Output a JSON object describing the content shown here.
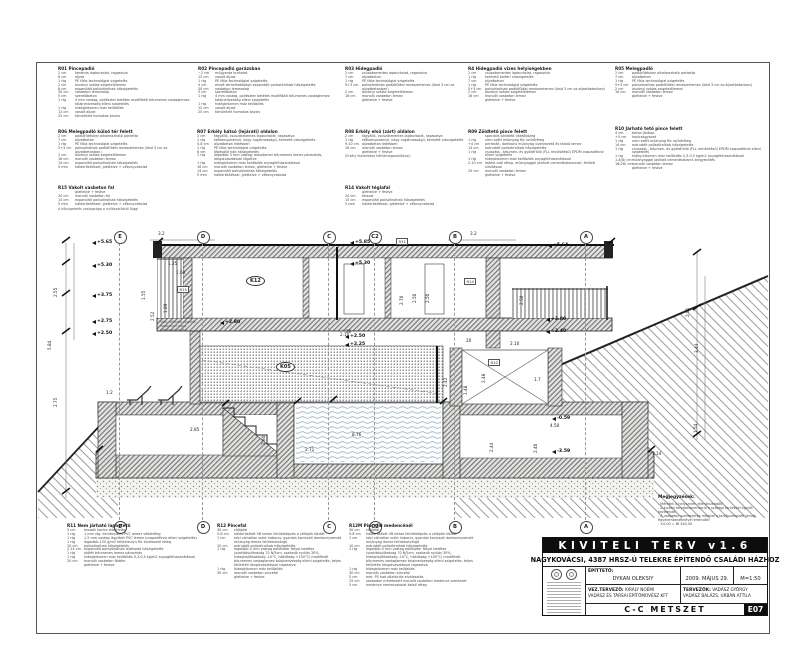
{
  "title_block": {
    "banner": "KIVITELI TERV v1.6",
    "project": "NAGYKOVÁCSI, 4387 HRSZ-Ú TELEKRE ÉPÍTENDŐ CSALÁDI HÁZHOZ",
    "client_label": "ÉPÍTTETŐ:",
    "client": "DYKAN OLEKSIY",
    "date": "2009. MÁJUS 29.",
    "scale": "M=1:50",
    "lead_label": "VEZ.TERVEZŐ:",
    "lead": "KIRÁLY NOÉMI",
    "firm": "VADÁSZ ÉS TÁRSAI ÉPÍTŐMŰVÉSZ KFT",
    "designers_label": "TERVEZŐK:",
    "designer1": "VADÁSZ GYÖRGY",
    "designer2": "VADÁSZ BALÁZS, URBÁN ATTILA",
    "drawing_title": "C-C METSZET",
    "sheet_code": "E07"
  },
  "notes": {
    "heading": "Megjegyzések:",
    "lines": [
      "- Méretek a helyszínen ellenőrizendők!",
      "- A kiviteli tervdokumentáció a szakági tervekkel együtt kezelendő!",
      "- A vasbeton szerkezetek méretei a tartószerkezeti tervek figyelembevételével értendők!",
      "- ±0,00 = Bf 340,00"
    ]
  },
  "colors": {
    "line": "#333333",
    "hatch": "#8a8a8a",
    "water": "#8fa3ad",
    "titleblock_bg": "#0d0d0d"
  },
  "spec_blocks": [
    {
      "id": "R01",
      "title": "Pincepadló",
      "x": 58,
      "y": 67,
      "w": 135,
      "rows": [
        [
          "2 cm",
          "kerámia lapburkolat, ragasztva"
        ],
        [
          "6 cm",
          "aljzat"
        ],
        [
          "1 rtg",
          "PE fólia technológiai szigetelés"
        ],
        [
          "2 cm",
          "ásványi szálas szigetelőlemez"
        ],
        [
          "6 cm",
          "expandált polisztirolhab hőszigetelés"
        ],
        [
          "30 cm",
          "vasbeton lemezalap"
        ],
        [
          "5 cm",
          "szerelőbeton"
        ],
        [
          "1 rtg",
          "4 mm vastag, poliészter betétes modifikált bitumenes vastaglemez talajnedvesség elleni szigetelés"
        ],
        [
          "1 rtg",
          "hidegbitumen máz kellősítés"
        ],
        [
          "12 cm",
          "vasalt aljzat"
        ],
        [
          "25 cm",
          "tömörített homokos kavics"
        ]
      ]
    },
    {
      "id": "R02",
      "title": "Pincepadló garázsban",
      "x": 198,
      "y": 67,
      "w": 142,
      "rows": [
        [
          "~2 cm",
          "műgyanta burkolat"
        ],
        [
          "12 cm",
          "vasalt aljzat"
        ],
        [
          "1 rtg",
          "PE fólia technológiai szigetelés"
        ],
        [
          "4 cm",
          "emelt terhelhetőségű expandált polisztirolhab hőszigetelés"
        ],
        [
          "30 cm",
          "vasbeton lemezalap"
        ],
        [
          "5 cm",
          "szerelőbeton"
        ],
        [
          "1 rtg",
          "4 mm vastag, poliészter betétes modifikált bitumenes vastaglemez talajnedvesség elleni szigetelés"
        ],
        [
          "1 rtg",
          "hidegbitumen máz kellősítés"
        ],
        [
          "12 cm",
          "vasalt aljzat"
        ],
        [
          "25 cm",
          "tömörített homokos kavics"
        ]
      ]
    },
    {
      "id": "R03",
      "title": "Hidegpadló",
      "x": 345,
      "y": 67,
      "w": 120,
      "rows": [
        [
          "2 cm",
          "csúszásmentes lapburkolat, ragasztva"
        ],
        [
          "7 cm",
          "aljzatbeton"
        ],
        [
          "1 rtg",
          "PE fólia technológiai szigetelés"
        ],
        [
          "5+3 cm",
          "polisztirolhab padlófűtési rendszerlemez (lásd 3 cm az aljzatbetonban)"
        ],
        [
          "2 cm",
          "ásványi szálas szigetelőlemez"
        ],
        [
          "16 cm",
          "monolit vasbeton lemez"
        ],
        [
          "",
          "glettelve + festve"
        ]
      ]
    },
    {
      "id": "R4",
      "title": "Hidegpadló vizes helyiségekben",
      "x": 468,
      "y": 67,
      "w": 142,
      "rows": [
        [
          "2 cm",
          "csúszásmentes lapburkolat, ragasztva"
        ],
        [
          "1 rtg",
          "kenhető beltéri vízszigetelés"
        ],
        [
          "7 cm",
          "aljzatbeton"
        ],
        [
          "1 rtg",
          "PE fólia technológiai szigetelés"
        ],
        [
          "5+3 cm",
          "polisztirolhab padlófűtési rendszerlemez (lásd 3 cm az aljzatbetonban)"
        ],
        [
          "2 cm",
          "ásványi szálas szigetelőlemez"
        ],
        [
          "16 cm",
          "monolit vasbeton lemez"
        ],
        [
          "",
          "glettelve + festve"
        ]
      ]
    },
    {
      "id": "R05",
      "title": "Melegpadló",
      "x": 615,
      "y": 67,
      "w": 148,
      "rows": [
        [
          "2 cm",
          "padlófűtéshez alkalmazható parketta"
        ],
        [
          "7 cm",
          "aljzatbeton"
        ],
        [
          "1 rtg",
          "PE fólia technológiai szigetelés"
        ],
        [
          "5+3 cm",
          "polisztirolhab padlófűtési rendszerlemez (lásd 3 cm az aljzatbetonban)"
        ],
        [
          "2 cm",
          "ásványi szálas szigetelőlemez"
        ],
        [
          "16 cm",
          "monolit vasbeton lemez"
        ],
        [
          "",
          "glettelve + festve"
        ]
      ]
    },
    {
      "id": "R06",
      "title": "Melegpadló külső tér felett",
      "x": 58,
      "y": 130,
      "w": 135,
      "rows": [
        [
          "2 cm",
          "padlófűtéshez alkalmazható parketta"
        ],
        [
          "7 cm",
          "aljzatbeton"
        ],
        [
          "1 rtg",
          "PE fólia technológiai szigetelés"
        ],
        [
          "5+3 cm",
          "polisztirolhab padlófűtési rendszerlemez (lásd 3 cm az aljzatbetonban)"
        ],
        [
          "2 cm",
          "ásványi szálas szigetelőlemez"
        ],
        [
          "16 cm",
          "monolit vasbeton lemez"
        ],
        [
          "14 cm",
          "expandált polisztirolhab hőszigetelés"
        ],
        [
          "5 mm",
          "hálóerősítéssel, glettelve + vékonyvakolat"
        ]
      ]
    },
    {
      "id": "R07",
      "title": "Erkély hátsó (lejárati) oldalon",
      "x": 197,
      "y": 130,
      "w": 143,
      "rows": [
        [
          "2 cm",
          "fagyálló, csúszásmentes lapburkolat, ragasztva"
        ],
        [
          "1 rtg",
          "kétkomponensű, nagy rugalmasságú, kenhető vízszigetelés"
        ],
        [
          "5-6 cm",
          "aljzatbeton lejtésben"
        ],
        [
          "1 rtg",
          "PE fólia technológiai szigetelés"
        ],
        [
          "6 cm",
          "lépésálló hab hőszigetelés"
        ],
        [
          "1 rtg",
          "legalább 3 mm vastag, elasztomer bitumenes lemez párazárás, lángolvasztással rögzítve"
        ],
        [
          "1 rtg",
          "hidegbitumen máz kellősítés anyagfelhasználással"
        ],
        [
          "16 cm",
          "monolit vasbeton lemez, glettelve + festve"
        ],
        [
          "14 cm",
          "expandált polisztirolhab hőszigetelés"
        ],
        [
          "5 mm",
          "hálóerősítéssel, glettelve + vékonyvakolat"
        ]
      ]
    },
    {
      "id": "R08",
      "title": "Erkély első (zárt) oldalon",
      "x": 345,
      "y": 130,
      "w": 150,
      "rows": [
        [
          "2 cm",
          "fagyálló, csúszásmentes lapburkolat, ragasztva"
        ],
        [
          "1 rtg",
          "kétkomponensű, nagy rugalmasságú, kenhető vízszigetelés"
        ],
        [
          "9-10 cm",
          "aljzatbeton lejtésben"
        ],
        [
          "16 cm",
          "monolit vasbeton lemez"
        ],
        [
          "",
          "glettelve + festve"
        ]
      ],
      "note": "(Erkély kialakítása hőhídmegszakítóval)"
    },
    {
      "id": "R09",
      "title": "Zöldtető pince felett",
      "x": 468,
      "y": 130,
      "w": 142,
      "rows": [
        [
          "",
          "speciális zöldtető ültetőközeg"
        ],
        [
          "1 rtg",
          "nem szőtt műanyag filc szűrőréteg"
        ],
        [
          "+4 cm",
          "perforált, domború műanyag vízelvezető és tároló lemez"
        ],
        [
          "14 cm",
          "extrudált polisztirolhab hőszigetelés"
        ],
        [
          "1 rtg",
          "csúszást-, bitumen- és gyökérálló (FLL minősítésű) EPDM csapadékvíz elleni szigetelés"
        ],
        [
          "1 rtg",
          "hidegbitumen máz kellősítés anyagfelhasználással"
        ],
        [
          "2-10 cm",
          "lejtést adó réteg, műanyaggal javított cementhabarccsal, felületi simítással"
        ],
        [
          "25 cm",
          "monolit vasbeton lemez"
        ],
        [
          "",
          "glettelve + festve"
        ]
      ]
    },
    {
      "id": "R10",
      "title": "Járható tető pince felett",
      "x": 615,
      "y": 127,
      "w": 150,
      "rows": [
        [
          "4 cm",
          "beton járólap"
        ],
        [
          "+5 cm",
          "kavicságyazat"
        ],
        [
          "1 rtg",
          "nem szőtt műanyag filc szűrőréteg"
        ],
        [
          "14 cm",
          "extrudált polisztirolhab hőszigetelés"
        ],
        [
          "1 rtg",
          "csúszást-, bitumen- és gyökérálló (FLL minősítésű) EPDM csapadékvíz elleni szigetelés"
        ],
        [
          "1 rtg",
          "hideg bitumen máz kellősítés 0,3-0,5 kg/m2 anyagfelhasználással"
        ],
        [
          "1-4(8) cm",
          "műanyaggal javított cementhabarcs kiegyenlítés"
        ],
        [
          "16(26) cm",
          "monolit vasbeton lemez"
        ],
        [
          "",
          "glettelve + festve"
        ]
      ]
    },
    {
      "id": "R15",
      "title": "Vakolt vasbeton fal",
      "x": 58,
      "y": 186,
      "w": 170,
      "rows": [
        [
          "",
          "glettelve + festve"
        ],
        [
          "20 cm",
          "monolit vasbeton fal"
        ],
        [
          "15 cm",
          "expandált polisztirolhab hőszigetelés"
        ],
        [
          "5 mm",
          "hálóerősítéssel, glettelve + vékonyvakolat"
        ]
      ],
      "note": "A hőszigetelés vastagsága a nyílászáróktól függ!"
    },
    {
      "id": "R14",
      "title": "Vakolt téglafal",
      "x": 345,
      "y": 186,
      "w": 150,
      "rows": [
        [
          "",
          "glettelve + festve"
        ],
        [
          "20 cm",
          "falazat"
        ],
        [
          "15 cm",
          "expandált polisztirolhab hőszigetelés"
        ],
        [
          "5 mm",
          "hálóerősítéssel, glettelve + vékonyvakolat"
        ]
      ]
    },
    {
      "id": "R11",
      "title": "Nem járható lapostető",
      "x": 67,
      "y": 524,
      "w": 195,
      "rows": [
        [
          "5 cm",
          "mosott kavics leterhelés"
        ],
        [
          "1 rtg",
          "1 mm vtg. keményített PVC lemez védőréteg"
        ],
        [
          "1 rtg",
          "1,5 mm vastag lágyított PVC lemez (csapadékvíz elleni szigetelés)"
        ],
        [
          "1 rtg",
          "legalább 120 g/m2 felületsúlyú filc elválasztó réteg"
        ],
        [
          "10 cm",
          "polisztirolhab hőszigetelés"
        ],
        [
          "2-14 cm",
          "expandált polisztirolhab lejtésadó hőszigetelés"
        ],
        [
          "1 rtg",
          "alátét bitumenes lemez párazárás"
        ],
        [
          "1 rtg",
          "hidegbitumen máz kellősítés 0,3-0,5 kg/m2 anyagfelhasználással"
        ],
        [
          "20 cm",
          "monolit vasbeton födém"
        ],
        [
          "",
          "glettelve + festve"
        ]
      ]
    },
    {
      "id": "R12",
      "title": "Pincefal",
      "x": 217,
      "y": 524,
      "w": 126,
      "rows": [
        [
          "30 cm",
          "cölöpfal"
        ],
        [
          "5-8 cm",
          "hálóerősített VB beton felületképzés a cölöpök között"
        ],
        [
          "1 cm",
          "kézi vízhatlan szórt habarcs, gyantás kavicsolt dombornyomott műanyag lemez felületszivárgó"
        ],
        [
          "10 cm",
          "extrudált polisztirolhab hőszigetelés"
        ],
        [
          "1 rtg",
          "legalább 4 mm vastag poliészter fátyol betétes (szakítószilárdság 70 N/5cm, szakadó nyúlás 30%, hideghajlíthatóság -10°C, hőállóság +100°C) modifikált bitumenes vastaglemez talajnedvesség elleni szigetelés, teljes felületén lángolvasztással ragasztva"
        ],
        [
          "1 rtg",
          "hidegbitumen máz kellősítés"
        ],
        [
          "30 cm",
          "monolit vasbeton pincefal"
        ],
        [
          "",
          "glettelve + festve"
        ]
      ]
    },
    {
      "id": "R12M",
      "title": "Pincefal medencénél",
      "x": 349,
      "y": 524,
      "w": 128,
      "rows": [
        [
          "30 cm",
          "cölöpfal"
        ],
        [
          "5-8 cm",
          "hálóerősített VB beton felületképzés a cölöpök között"
        ],
        [
          "1 cm",
          "kézi vízhatlan szórt habarcs, gyantás kavicsolt dombornyomott műanyag lemez felületszivárgó"
        ],
        [
          "10 cm",
          "extrudált polisztirolhab hőszigetelés"
        ],
        [
          "1 rtg",
          "legalább 4 mm vastag poliészter fátyol betétes (szakítószilárdság 70 N/5cm, szakadó nyúlás 30%, hideghajlíthatóság -10°C, hőállóság +100°C) modifikált bitumenes vastaglemez talajnedvesség elleni szigetelés, teljes felületén lángolvasztással ragasztva"
        ],
        [
          "1 rtg",
          "hidegbitumen máz kellősítés"
        ],
        [
          "30 cm",
          "monolit vasbeton pincefal"
        ],
        [
          "5 cm",
          "extr. PS hab dilatációs elválasztás"
        ],
        [
          "25 cm",
          "szabadon méretezett monolit vasbeton medence szerkezet"
        ],
        [
          "3 cm",
          "medence nemesvakolat belső réteg"
        ]
      ]
    }
  ],
  "drawing": {
    "grid_y1": 243,
    "grid_y2": 520,
    "bubble_top": 236,
    "bubble_bottom": 526,
    "grids": [
      [
        "E",
        119
      ],
      [
        "D",
        202
      ],
      [
        "C",
        328
      ],
      [
        "C2",
        374
      ],
      [
        "B",
        454
      ],
      [
        "A",
        585
      ]
    ],
    "levels": [
      [
        "+5.65",
        92,
        240
      ],
      [
        "+5.30",
        92,
        263
      ],
      [
        "+3.75",
        92,
        293
      ],
      [
        "+2.75",
        92,
        319
      ],
      [
        "+2.50",
        92,
        331
      ],
      [
        "+5.85",
        350,
        240
      ],
      [
        "+5.30",
        350,
        261
      ],
      [
        "+2.50",
        345,
        334
      ],
      [
        "+2.25",
        345,
        342
      ],
      [
        "+2.80",
        220,
        320
      ],
      [
        "+5.64",
        548,
        243
      ],
      [
        "+2.80",
        546,
        317
      ],
      [
        "+2.40",
        546,
        329
      ],
      [
        "-0.59",
        552,
        416
      ],
      [
        "-3.59",
        552,
        449
      ]
    ],
    "dims": [
      [
        "2.55",
        58,
        292,
        1
      ],
      [
        "5.84",
        52,
        345,
        1
      ],
      [
        "2.75",
        58,
        402,
        1
      ],
      [
        "2.51",
        690,
        312,
        1
      ],
      [
        "3.44",
        699,
        348,
        1
      ],
      [
        "3.2",
        158,
        231,
        0
      ],
      [
        "3.2",
        470,
        231,
        0
      ],
      [
        "1.25",
        168,
        261,
        0
      ],
      [
        "1.60",
        176,
        270,
        0
      ],
      [
        "1.55",
        146,
        295,
        1
      ],
      [
        "2.52",
        155,
        316,
        1
      ],
      [
        "1.89",
        168,
        308,
        1
      ],
      [
        "2.70",
        404,
        300,
        1
      ],
      [
        "2.50",
        417,
        298,
        1
      ],
      [
        "2.50",
        430,
        298,
        1
      ],
      [
        "2.50",
        524,
        300,
        1
      ],
      [
        "2.10",
        340,
        332,
        0
      ],
      [
        "2.10",
        510,
        341,
        0
      ],
      [
        "2.85",
        190,
        427,
        0
      ],
      [
        "2.80",
        266,
        440,
        1
      ],
      [
        "2.71",
        305,
        447,
        0
      ],
      [
        "8.76",
        352,
        432,
        0
      ],
      [
        "2.42",
        448,
        382,
        1
      ],
      [
        "1.48",
        468,
        390,
        1
      ],
      [
        "2.48",
        486,
        378,
        1
      ],
      [
        "1.7",
        534,
        377,
        0
      ],
      [
        "4.50",
        550,
        423,
        0
      ],
      [
        "2.44",
        494,
        447,
        1
      ],
      [
        "2.40",
        538,
        448,
        1
      ],
      [
        "1.14",
        652,
        451,
        0
      ],
      [
        "1.54",
        698,
        428,
        1
      ],
      [
        "1:2",
        106,
        390,
        0
      ],
      [
        "20",
        346,
        329,
        0
      ],
      [
        "20",
        466,
        338,
        0
      ]
    ],
    "rooms": [
      [
        "K12",
        246,
        276
      ],
      [
        "K05",
        276,
        362
      ]
    ],
    "tags": [
      [
        "R11",
        396,
        238
      ],
      [
        "R15",
        177,
        286
      ],
      [
        "R14",
        464,
        278
      ],
      [
        "R10",
        488,
        359
      ]
    ],
    "sidenote": {
      "x": 160,
      "y": 321,
      "lines": [
        "Stab. kőkorlát rögzítés",
        "Raupanzer lapra",
        "vékonyvakolattal"
      ]
    }
  }
}
